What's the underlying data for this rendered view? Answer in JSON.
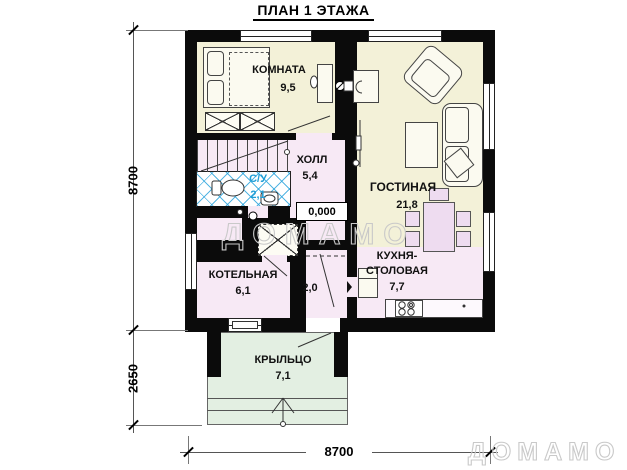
{
  "title": "ПЛАН 1 ЭТАЖА",
  "dimensions": {
    "left_height": "8700",
    "left_porch": "2650",
    "bottom_width": "8700"
  },
  "level_mark": "0,000",
  "rooms": {
    "bedroom": {
      "name": "КОМНАТА",
      "area": "9,5"
    },
    "hall": {
      "name": "ХОЛЛ",
      "area": "5,4"
    },
    "wc": {
      "name": "С/У",
      "area": "2,1"
    },
    "living": {
      "name": "ГОСТИНАЯ",
      "area": "21,8"
    },
    "boiler": {
      "name": "КОТЕЛЬНАЯ",
      "area": "6,1"
    },
    "vestibule": {
      "area": "2,0"
    },
    "kitchen": {
      "name_line1": "КУХНЯ-",
      "name_line2": "СТОЛОВАЯ",
      "area": "7,7"
    },
    "porch": {
      "name": "КРЫЛЬЦО",
      "area": "7,1"
    }
  },
  "watermark": {
    "center": "ДОМАМО",
    "corner": "ДОМАМО"
  },
  "colors": {
    "room_cream": "#f3f1d8",
    "room_pink": "#f7e9f5",
    "porch_green": "#e3efe2",
    "tile_blue": "#29a3dc",
    "furniture_lavender": "#eedcf0",
    "wall_black": "#0b0b0b",
    "watermark_gray": "#c9c9c9"
  }
}
